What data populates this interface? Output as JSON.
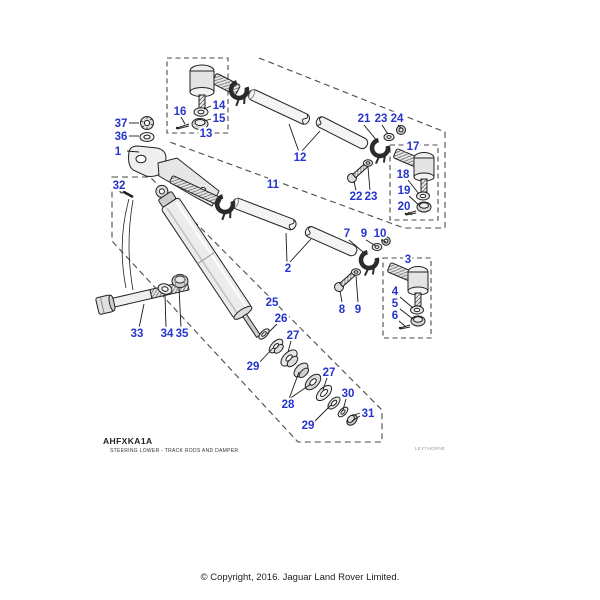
{
  "footer": {
    "code": "AHFXKA1A",
    "subtitle": "STEERING LOWER - TRACK RODS AND DAMPER",
    "watermark": "LEYTHORNE",
    "copyright": "© Copyright, 2016. Jaguar Land Rover Limited."
  },
  "diagram": {
    "label_color": "#2534cd",
    "line_color": "#222222",
    "part_labels": [
      {
        "text": "1",
        "x": 118,
        "y": 155,
        "leaders": [
          [
            127,
            151,
            139,
            152
          ]
        ]
      },
      {
        "text": "37",
        "x": 121,
        "y": 127,
        "leaders": [
          [
            129,
            123,
            139,
            123
          ]
        ]
      },
      {
        "text": "36",
        "x": 121,
        "y": 140,
        "leaders": [
          [
            129,
            136,
            139,
            136
          ]
        ]
      },
      {
        "text": "16",
        "x": 180,
        "y": 115,
        "leaders": [
          [
            181,
            117,
            185,
            124
          ]
        ]
      },
      {
        "text": "14",
        "x": 219,
        "y": 109,
        "leaders": [
          [
            211,
            106,
            204,
            109
          ]
        ]
      },
      {
        "text": "15",
        "x": 219,
        "y": 122,
        "leaders": [
          [
            211,
            119,
            204,
            121
          ]
        ]
      },
      {
        "text": "13",
        "x": 206,
        "y": 137,
        "leaders": []
      },
      {
        "text": "12",
        "x": 300,
        "y": 161,
        "leaders": [
          [
            299,
            152,
            289,
            124
          ],
          [
            301,
            152,
            320,
            131
          ]
        ]
      },
      {
        "text": "21",
        "x": 364,
        "y": 122,
        "leaders": [
          [
            364,
            125,
            378,
            142
          ]
        ]
      },
      {
        "text": "23",
        "x": 381,
        "y": 122,
        "leaders": [
          [
            382,
            125,
            388,
            134
          ]
        ]
      },
      {
        "text": "24",
        "x": 397,
        "y": 122,
        "leaders": [
          [
            398,
            125,
            401,
            128
          ]
        ]
      },
      {
        "text": "17",
        "x": 413,
        "y": 150,
        "leaders": []
      },
      {
        "text": "18",
        "x": 403,
        "y": 178,
        "leaders": [
          [
            408,
            180,
            419,
            194
          ]
        ]
      },
      {
        "text": "19",
        "x": 404,
        "y": 194,
        "leaders": [
          [
            409,
            196,
            420,
            206
          ]
        ]
      },
      {
        "text": "20",
        "x": 404,
        "y": 210,
        "leaders": [
          [
            408,
            212,
            412,
            215
          ]
        ]
      },
      {
        "text": "22",
        "x": 356,
        "y": 200,
        "leaders": [
          [
            356,
            191,
            354,
            181
          ]
        ]
      },
      {
        "text": "23",
        "x": 371,
        "y": 200,
        "leaders": [
          [
            370,
            191,
            368,
            167
          ]
        ]
      },
      {
        "text": "11",
        "x": 273,
        "y": 188,
        "leaders": []
      },
      {
        "text": "2",
        "x": 288,
        "y": 272,
        "leaders": [
          [
            287,
            263,
            286,
            233
          ],
          [
            289,
            263,
            311,
            239
          ]
        ]
      },
      {
        "text": "7",
        "x": 347,
        "y": 237,
        "leaders": [
          [
            349,
            240,
            363,
            252
          ]
        ]
      },
      {
        "text": "9",
        "x": 364,
        "y": 237,
        "leaders": [
          [
            366,
            240,
            376,
            246
          ]
        ]
      },
      {
        "text": "10",
        "x": 380,
        "y": 237,
        "leaders": [
          [
            381,
            240,
            386,
            242
          ]
        ]
      },
      {
        "text": "8",
        "x": 342,
        "y": 313,
        "leaders": [
          [
            342,
            302,
            340,
            291
          ]
        ]
      },
      {
        "text": "9",
        "x": 358,
        "y": 313,
        "leaders": [
          [
            358,
            302,
            356,
            276
          ]
        ]
      },
      {
        "text": "3",
        "x": 408,
        "y": 263,
        "leaders": []
      },
      {
        "text": "4",
        "x": 395,
        "y": 295,
        "leaders": [
          [
            400,
            297,
            413,
            308
          ]
        ]
      },
      {
        "text": "5",
        "x": 395,
        "y": 307,
        "leaders": [
          [
            400,
            309,
            413,
            319
          ]
        ]
      },
      {
        "text": "6",
        "x": 395,
        "y": 319,
        "leaders": [
          [
            399,
            321,
            405,
            326
          ]
        ]
      },
      {
        "text": "32",
        "x": 119,
        "y": 189,
        "leaders": [
          [
            123,
            191,
            128,
            194
          ]
        ]
      },
      {
        "text": "25",
        "x": 272,
        "y": 306,
        "leaders": []
      },
      {
        "text": "26",
        "x": 281,
        "y": 322,
        "leaders": [
          [
            277,
            324,
            267,
            334
          ]
        ]
      },
      {
        "text": "27",
        "x": 293,
        "y": 339,
        "leaders": [
          [
            291,
            341,
            288,
            352
          ]
        ]
      },
      {
        "text": "29",
        "x": 253,
        "y": 370,
        "leaders": [
          [
            257,
            365,
            273,
            348
          ]
        ]
      },
      {
        "text": "28",
        "x": 288,
        "y": 408,
        "leaders": [
          [
            289,
            399,
            299,
            372
          ],
          [
            289,
            399,
            311,
            384
          ]
        ]
      },
      {
        "text": "27",
        "x": 329,
        "y": 376,
        "leaders": [
          [
            327,
            378,
            323,
            390
          ]
        ]
      },
      {
        "text": "30",
        "x": 348,
        "y": 397,
        "leaders": [
          [
            346,
            399,
            343,
            410
          ]
        ]
      },
      {
        "text": "29",
        "x": 308,
        "y": 429,
        "leaders": [
          [
            312,
            424,
            331,
            405
          ]
        ]
      },
      {
        "text": "31",
        "x": 368,
        "y": 417,
        "leaders": [
          [
            360,
            413,
            354,
            415
          ],
          [
            360,
            416,
            352,
            421
          ]
        ]
      },
      {
        "text": "33",
        "x": 137,
        "y": 337,
        "leaders": [
          [
            139,
            328,
            144,
            304
          ]
        ]
      },
      {
        "text": "34",
        "x": 167,
        "y": 337,
        "leaders": [
          [
            166,
            328,
            165,
            295
          ]
        ]
      },
      {
        "text": "35",
        "x": 182,
        "y": 337,
        "leaders": [
          [
            181,
            328,
            179,
            288
          ]
        ]
      }
    ]
  }
}
